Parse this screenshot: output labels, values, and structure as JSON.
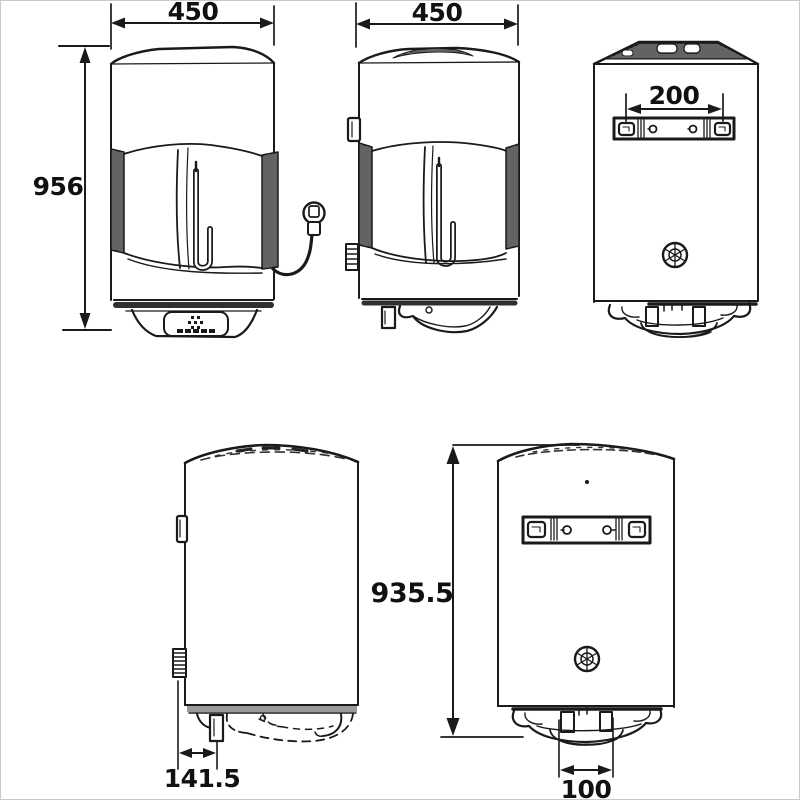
{
  "colors": {
    "line": "#1a1a1a",
    "background": "#ffffff",
    "border": "#c9c9c9",
    "hatch_dark": "#3a3a3a",
    "hatch_base": "#8c8c8c"
  },
  "dimensions": {
    "front_width": "450",
    "side_width": "450",
    "overall_height": "956",
    "bracket_hole_spacing": "200",
    "body_height": "935.5",
    "bottom_clearance": "141.5",
    "outlet_spacing": "100"
  }
}
